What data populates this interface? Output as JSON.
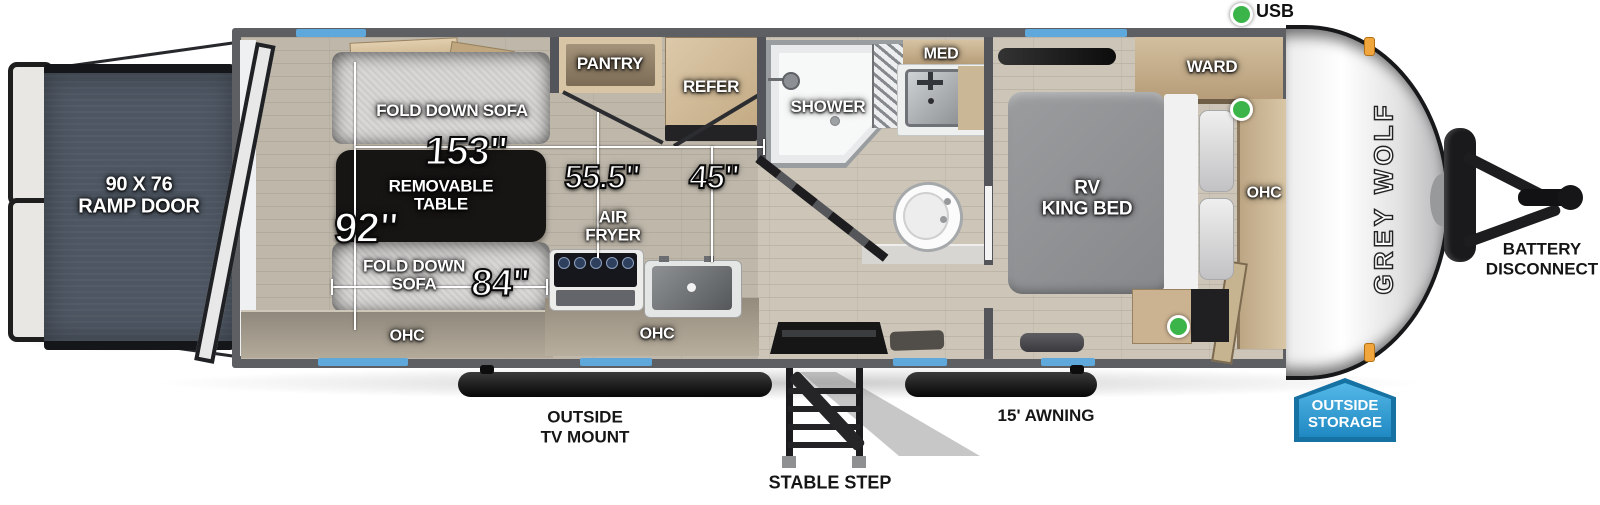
{
  "legend": {
    "usb_label": "USB"
  },
  "rooms": {
    "ramp_door": "90 X 76\nRAMP DOOR",
    "fold_down_sofa_top": "FOLD DOWN SOFA",
    "removable_table": "REMOVABLE\nTABLE",
    "fold_down_sofa_bottom": "FOLD DOWN\nSOFA",
    "ohc_garage": "OHC",
    "ohc_kitchen": "OHC",
    "ohc_bedroom": "OHC",
    "air_fryer": "AIR\nFRYER",
    "pantry": "PANTRY",
    "refer": "REFER",
    "shower": "SHOWER",
    "med": "MED",
    "ward": "WARD",
    "rv_king_bed": "RV\nKING BED"
  },
  "dimensions": {
    "garage_length": "153\"",
    "garage_width": "92\"",
    "kitchen_width": "55.5\"",
    "entry_width": "45\"",
    "sofa_length": "84\""
  },
  "exterior": {
    "brand": "GREY WOLF",
    "outside_tv_mount": "OUTSIDE\nTV MOUNT",
    "stable_step": "STABLE STEP",
    "awning": "15' AWNING",
    "battery_disconnect": "BATTERY\nDISCONNECT",
    "outside_storage": "OUTSIDE\nSTORAGE"
  },
  "colors": {
    "window_blue": "#5fa8dc",
    "usb_green": "#3bb54a",
    "badge_blue": "#2a93c9",
    "badge_border": "#1572a3",
    "marker_orange": "#f0a63c",
    "wall_gray": "#54555a",
    "ramp_slate": "#4d5662",
    "table_black": "#171513"
  }
}
